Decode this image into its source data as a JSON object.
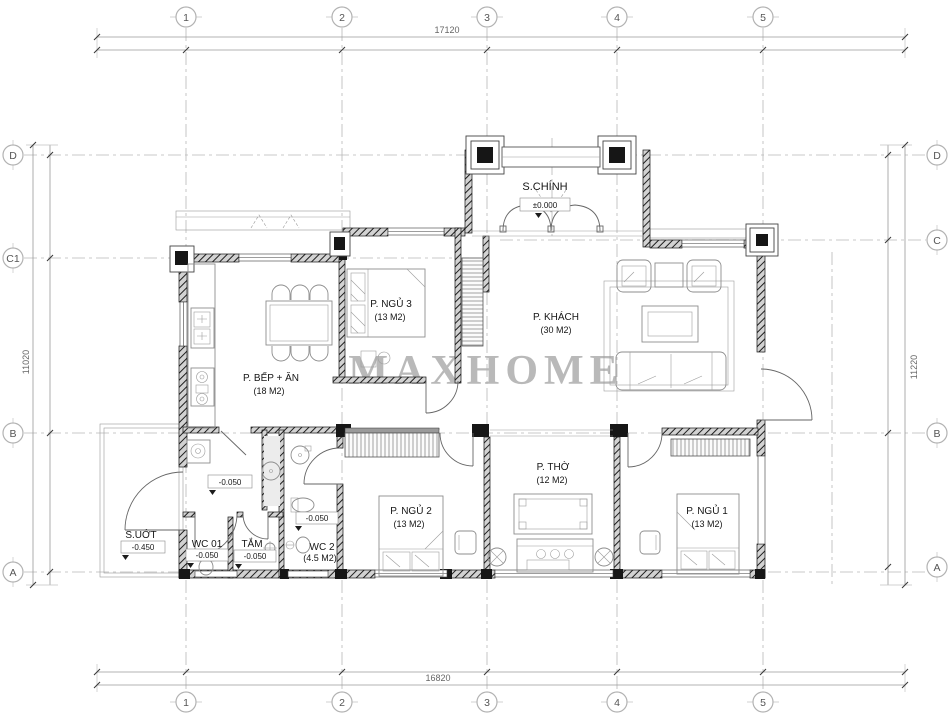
{
  "drawing": {
    "watermark": "MAXHOME",
    "grid": {
      "cols": [
        "1",
        "2",
        "3",
        "4",
        "5"
      ],
      "rows_left": [
        "D",
        "C1",
        "B",
        "A"
      ],
      "rows_right": [
        "D",
        "C",
        "B",
        "A"
      ]
    },
    "dimensions": {
      "top": "17120",
      "bottom": "16820",
      "left": "11020",
      "right": "11220"
    },
    "rooms": {
      "porch": {
        "name": "S.CHÍNH",
        "level": "±0.000"
      },
      "kitchen": {
        "name": "P. BẾP + ĂN",
        "area": "(18 M2)"
      },
      "bed3": {
        "name": "P. NGỦ 3",
        "area": "(13 M2)"
      },
      "living": {
        "name": "P. KHÁCH",
        "area": "(30 M2)"
      },
      "worship": {
        "name": "P. THỜ",
        "area": "(12 M2)"
      },
      "bed2": {
        "name": "P. NGỦ 2",
        "area": "(13 M2)"
      },
      "bed1": {
        "name": "P. NGỦ 1",
        "area": "(13 M2)"
      },
      "wc2": {
        "name": "WC 2",
        "area": "(4.5 M2)",
        "level": "-0.050"
      },
      "wc1": {
        "name": "WC 01",
        "level": "-0.050"
      },
      "bath": {
        "name": "TẮM",
        "level": "-0.050"
      },
      "wetyard": {
        "name": "S.UỚT",
        "level": "-0.450"
      },
      "corridor": {
        "level": "-0.050"
      }
    }
  }
}
